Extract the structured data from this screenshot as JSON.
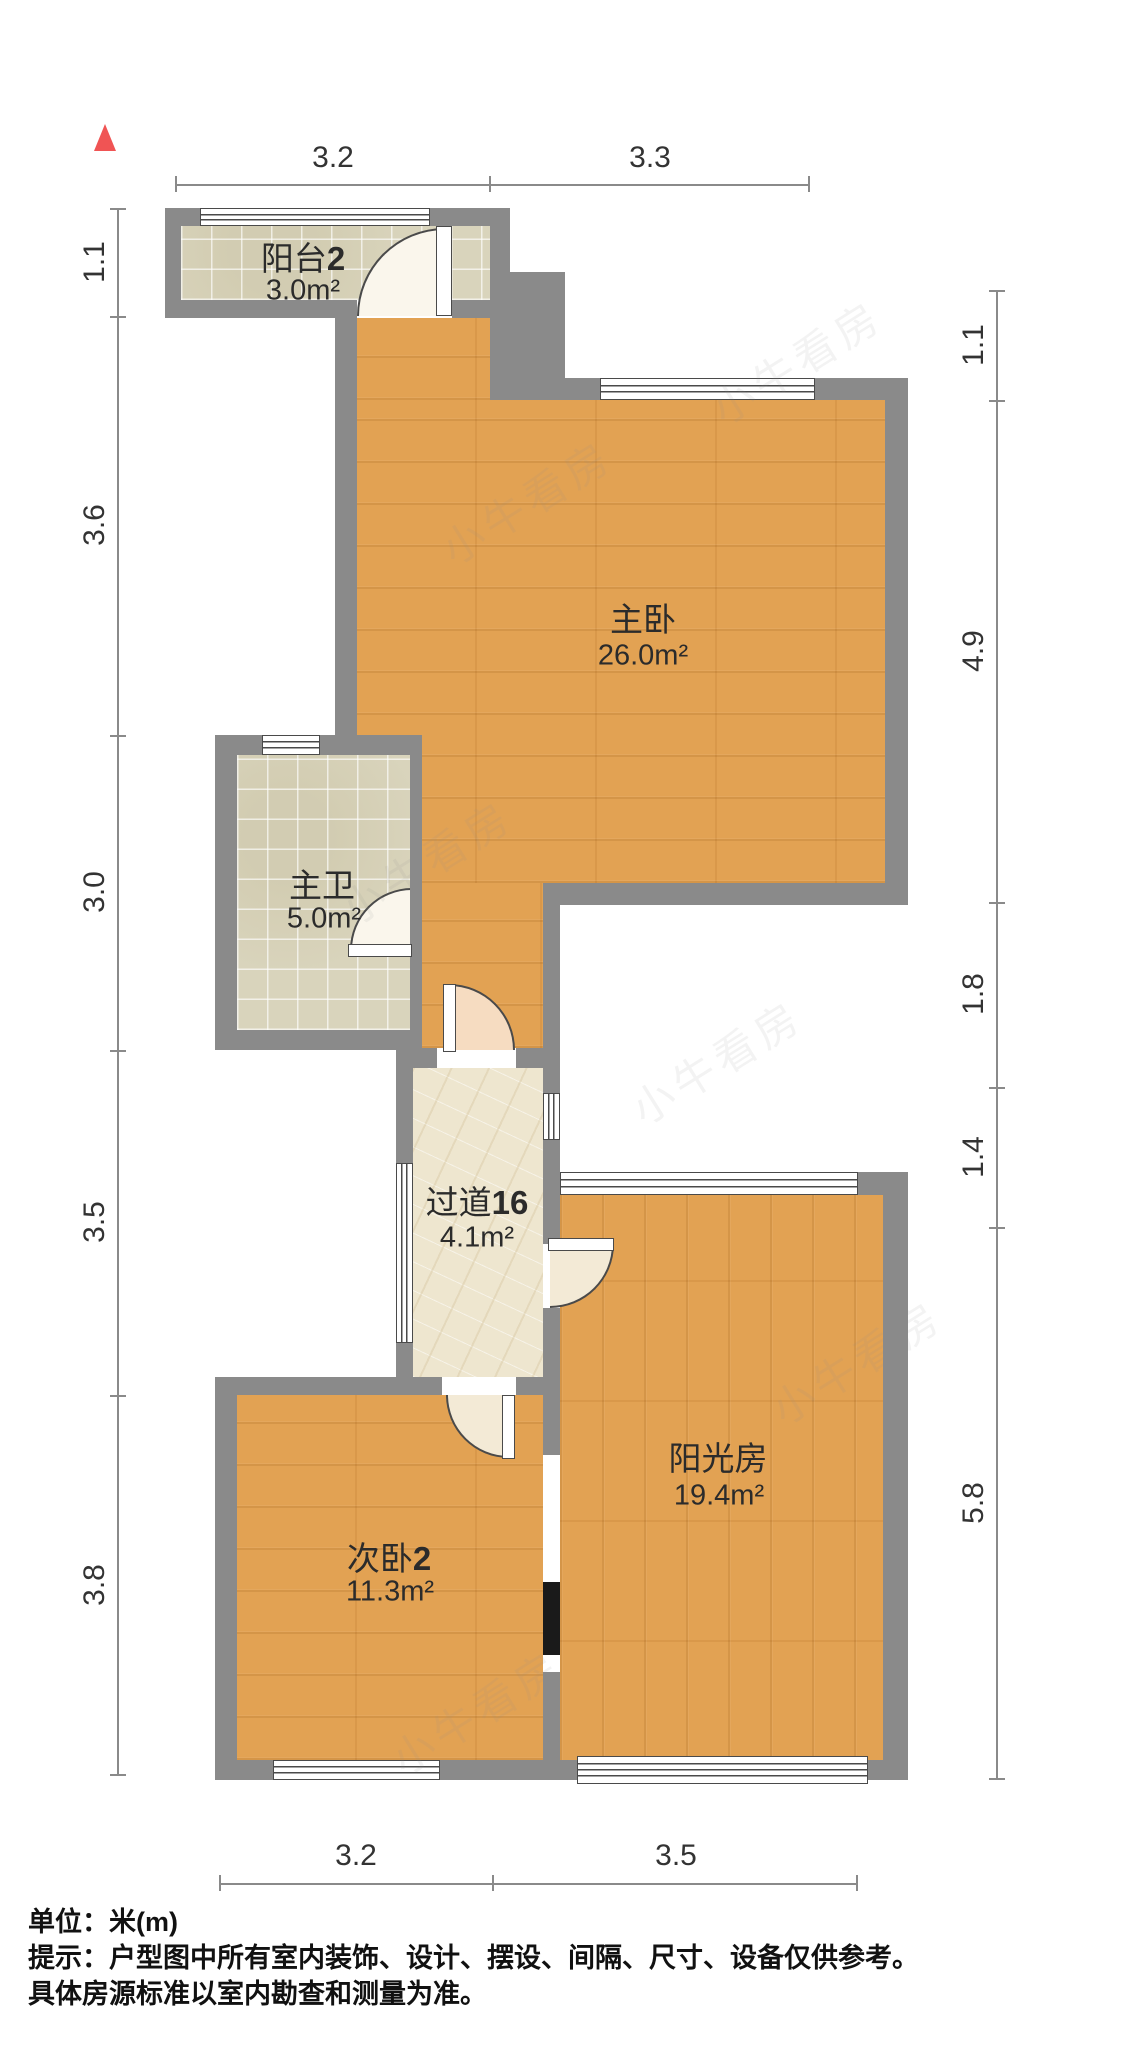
{
  "rooms": [
    {
      "id": "balcony2",
      "name": "阳台",
      "num": "2",
      "area": "3.0m²"
    },
    {
      "id": "master-bedroom",
      "name": "主卧",
      "num": "",
      "area": "26.0m²"
    },
    {
      "id": "master-bath",
      "name": "主卫",
      "num": "",
      "area": "5.0m²"
    },
    {
      "id": "corridor",
      "name": "过道",
      "num": "16",
      "area": "4.1m²"
    },
    {
      "id": "sunroom",
      "name": "阳光房",
      "num": "",
      "area": "19.4m²"
    },
    {
      "id": "bedroom2",
      "name": "次卧",
      "num": "2",
      "area": "11.3m²"
    }
  ],
  "dimensions": {
    "top": [
      "3.2",
      "3.3"
    ],
    "bottom": [
      "3.2",
      "3.5"
    ],
    "left": [
      "1.1",
      "3.6",
      "3.0",
      "3.5",
      "3.8"
    ],
    "right": [
      "1.1",
      "4.9",
      "1.8",
      "1.4",
      "5.8"
    ]
  },
  "footer": {
    "unit_label": "单位：米(m)",
    "tip_line1": "提示：户型图中所有室内装饰、设计、摆设、间隔、尺寸、设备仅供参考。",
    "tip_line2": "具体房源标准以室内勘查和测量为准。"
  },
  "watermark": {
    "text": "小牛看房"
  },
  "colors": {
    "wall": "#8a8a8a",
    "wood": "#e2a253",
    "tile": "#d9d4bc",
    "marble": "#eee6cf",
    "dim": "#8a8a8a",
    "accent": "#f05454"
  }
}
